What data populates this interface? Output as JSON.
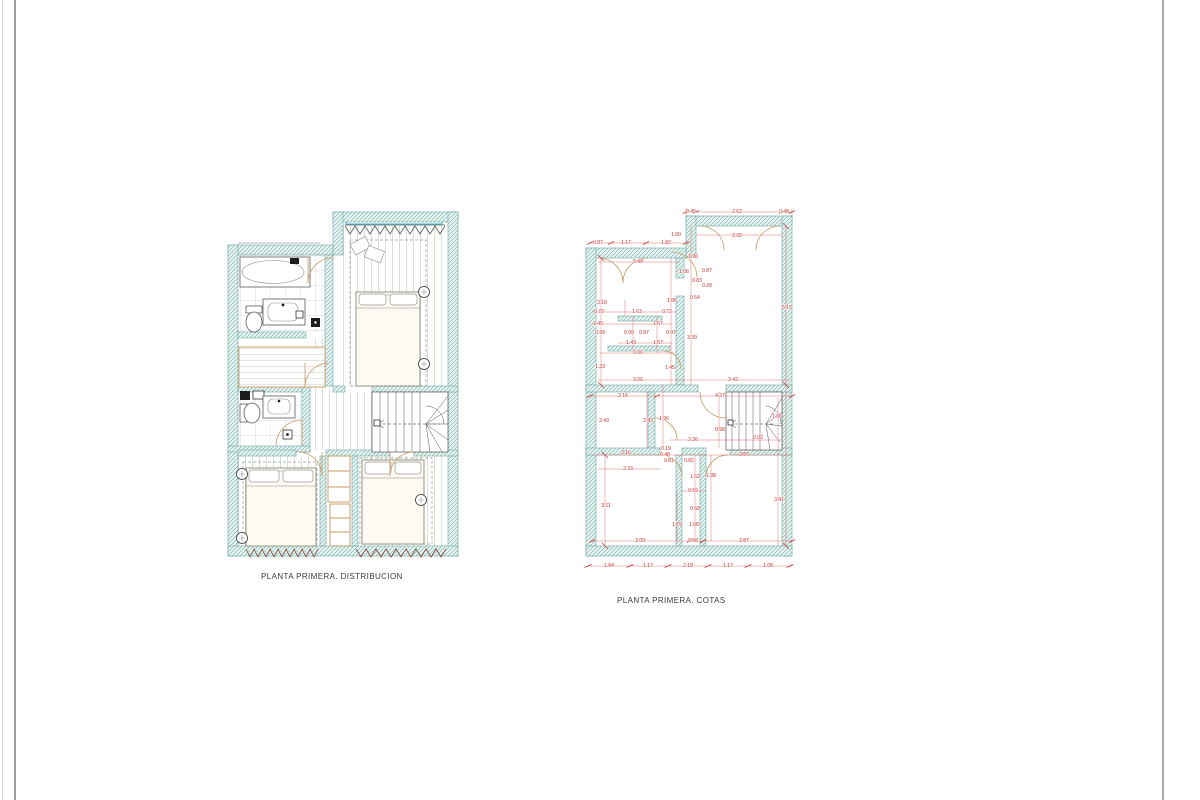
{
  "colors": {
    "wall_hatch": "#79b8b1",
    "dimension_red": "#cc2b2b",
    "door_tan": "#c89a62",
    "window_cyan": "#3ab5c8"
  },
  "plans": {
    "distribucion": {
      "title": "PLANTA PRIMERA. DISTRIBUCION"
    },
    "cotas": {
      "title": "PLANTA PRIMERA. COTAS",
      "dimensions": [
        {
          "t": "0.45",
          "x": 691,
          "y": 213
        },
        {
          "t": "2.62",
          "x": 737,
          "y": 213
        },
        {
          "t": "0.48",
          "x": 784,
          "y": 213
        },
        {
          "t": "2.92",
          "x": 737,
          "y": 237
        },
        {
          "t": "1.00",
          "x": 676,
          "y": 236
        },
        {
          "t": "0.87",
          "x": 598,
          "y": 244
        },
        {
          "t": "1.17",
          "x": 626,
          "y": 244
        },
        {
          "t": "1.82",
          "x": 666,
          "y": 244
        },
        {
          "t": "5.48",
          "x": 638,
          "y": 263
        },
        {
          "t": "1.90",
          "x": 693,
          "y": 258
        },
        {
          "t": "1.06",
          "x": 684,
          "y": 273
        },
        {
          "t": "0.87",
          "x": 707,
          "y": 272
        },
        {
          "t": "0.83",
          "x": 697,
          "y": 282
        },
        {
          "t": "0.28",
          "x": 707,
          "y": 287
        },
        {
          "t": "0.54",
          "x": 695,
          "y": 299
        },
        {
          "t": "3.18",
          "x": 602,
          "y": 304
        },
        {
          "t": "1.06",
          "x": 672,
          "y": 302
        },
        {
          "t": "5.17",
          "x": 787,
          "y": 309
        },
        {
          "t": "0.72",
          "x": 599,
          "y": 313
        },
        {
          "t": "1.63",
          "x": 637,
          "y": 313
        },
        {
          "t": "0.72",
          "x": 667,
          "y": 313
        },
        {
          "t": "1.45",
          "x": 598,
          "y": 325
        },
        {
          "t": "1.57",
          "x": 658,
          "y": 325
        },
        {
          "t": "0.99",
          "x": 600,
          "y": 334
        },
        {
          "t": "0.99",
          "x": 629,
          "y": 334
        },
        {
          "t": "0.97",
          "x": 644,
          "y": 334
        },
        {
          "t": "0.97",
          "x": 671,
          "y": 334
        },
        {
          "t": "1.43",
          "x": 631,
          "y": 344
        },
        {
          "t": "1.57",
          "x": 658,
          "y": 344
        },
        {
          "t": "3.06",
          "x": 638,
          "y": 354
        },
        {
          "t": "3.39",
          "x": 692,
          "y": 339
        },
        {
          "t": "1.33",
          "x": 600,
          "y": 368
        },
        {
          "t": "1.45",
          "x": 670,
          "y": 369
        },
        {
          "t": "3.06",
          "x": 638,
          "y": 381
        },
        {
          "t": "3.42",
          "x": 733,
          "y": 381
        },
        {
          "t": "2.16",
          "x": 623,
          "y": 397
        },
        {
          "t": "4.37",
          "x": 720,
          "y": 397
        },
        {
          "t": "2.43",
          "x": 604,
          "y": 422
        },
        {
          "t": "2.43",
          "x": 648,
          "y": 422
        },
        {
          "t": "1.96",
          "x": 664,
          "y": 420
        },
        {
          "t": "0.98",
          "x": 720,
          "y": 431
        },
        {
          "t": "2.36",
          "x": 693,
          "y": 441
        },
        {
          "t": "2.02",
          "x": 758,
          "y": 439
        },
        {
          "t": "1.06",
          "x": 777,
          "y": 418
        },
        {
          "t": "2.16",
          "x": 626,
          "y": 454
        },
        {
          "t": "0.19",
          "x": 666,
          "y": 450
        },
        {
          "t": "0.48",
          "x": 665,
          "y": 456
        },
        {
          "t": "0.81",
          "x": 669,
          "y": 462
        },
        {
          "t": "0.82",
          "x": 689,
          "y": 462
        },
        {
          "t": "2.87",
          "x": 744,
          "y": 456
        },
        {
          "t": "2.33",
          "x": 628,
          "y": 470
        },
        {
          "t": "1.62",
          "x": 695,
          "y": 478
        },
        {
          "t": "1.88",
          "x": 711,
          "y": 477
        },
        {
          "t": "0.59",
          "x": 693,
          "y": 492
        },
        {
          "t": "3.11",
          "x": 606,
          "y": 507
        },
        {
          "t": "0.58",
          "x": 695,
          "y": 510
        },
        {
          "t": "1.79",
          "x": 677,
          "y": 526
        },
        {
          "t": "1.68",
          "x": 694,
          "y": 526
        },
        {
          "t": "3.41",
          "x": 779,
          "y": 501
        },
        {
          "t": "3.09",
          "x": 640,
          "y": 542
        },
        {
          "t": "0.58",
          "x": 693,
          "y": 542
        },
        {
          "t": "2.87",
          "x": 744,
          "y": 542
        },
        {
          "t": "1.84",
          "x": 609,
          "y": 567
        },
        {
          "t": "1.17",
          "x": 648,
          "y": 567
        },
        {
          "t": "2.18",
          "x": 688,
          "y": 567
        },
        {
          "t": "1.17",
          "x": 728,
          "y": 567
        },
        {
          "t": "1.08",
          "x": 768,
          "y": 567
        }
      ]
    }
  }
}
